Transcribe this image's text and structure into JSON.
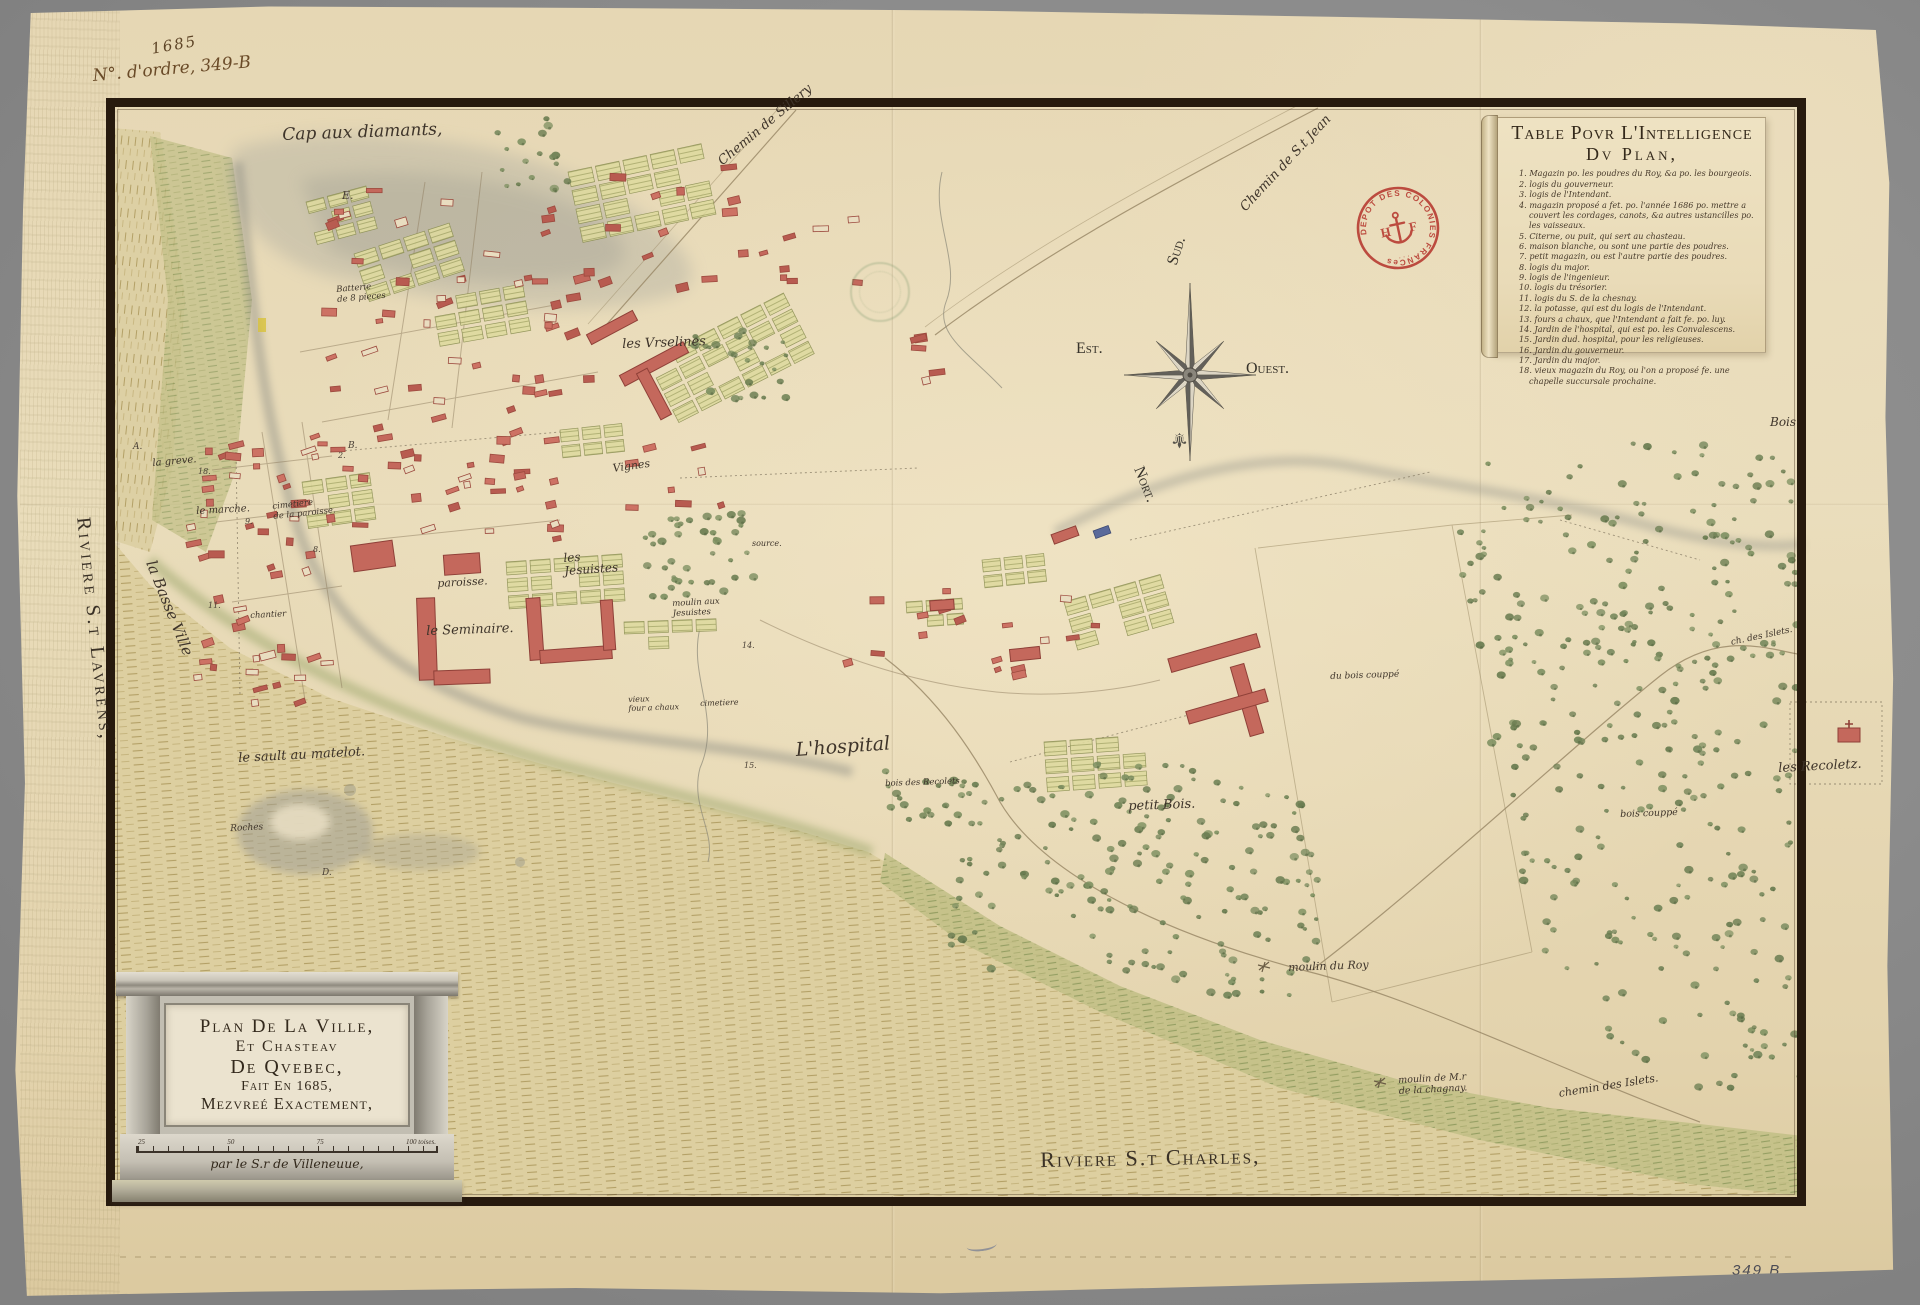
{
  "annotations": {
    "year": "1685",
    "order_number": "N°. d'ordre, 349-B",
    "corner_number": "349 B"
  },
  "legend": {
    "title_line1": "Table Povr L'Intelligence",
    "title_line2": "Dv Plan,",
    "items": [
      "Magazin po. les poudres du Roy, &a po. les bourgeois.",
      "logis du gouverneur.",
      "logis de l'Intendant.",
      "magazin proposé a fet. po. l'année 1686 po. mettre a couvert les cordages, canots, &a autres ustancilles po. les vaisseaux.",
      "Citerne, ou puit, qui sert au chasteau.",
      "maison blanche, ou sont une partie des poudres.",
      "petit magazin, ou est l'autre partie des poudres.",
      "logis du major.",
      "logis de l'ingenieur.",
      "logis du trésorier.",
      "logis du S. de la chesnay.",
      "la potasse, qui est du logis de l'Intendant.",
      "fours a chaux, que l'Intendant a fait fe. po. luy.",
      "Jardin de l'hospital, qui est po. les Convalescens.",
      "Jardin dud. hospital, pour les religieuses.",
      "Jardin du gouverneur.",
      "Jardin du major.",
      "vieux magazin du Roy, ou l'on a proposé fe. une chapelle succursale prochaine."
    ]
  },
  "cartouche": {
    "line1": "Plan De La Ville,",
    "line2": "Et Chasteav",
    "line3": "De Qvebec,",
    "line4": "Fait En 1685,",
    "line5": "Mezvreé Exactement,",
    "scale_labels": [
      "25",
      "50",
      "75",
      "100 toises."
    ],
    "author": "par le S.r de Villeneuue,"
  },
  "compass": {
    "north": "Nort.",
    "south": "Sud.",
    "east": "Est.",
    "west": "Ouest."
  },
  "stamps": {
    "red_text": "DEPOT DES COLONIES FRANCes",
    "red_h": "H",
    "red_f": "F"
  },
  "map_labels": [
    {
      "t": "Cap aux diamants,",
      "x": 282,
      "y": 126,
      "r": -2,
      "s": 17,
      "c": "scr"
    },
    {
      "t": "Chemin de Sillery",
      "x": 716,
      "y": 158,
      "r": -40,
      "s": 13,
      "c": "scr"
    },
    {
      "t": "Chemin de S.t Jean",
      "x": 1238,
      "y": 205,
      "r": -47,
      "s": 13,
      "c": "scr"
    },
    {
      "t": "E.",
      "x": 342,
      "y": 190,
      "r": 0,
      "s": 11,
      "c": "ink"
    },
    {
      "t": "les Vrselines",
      "x": 622,
      "y": 338,
      "r": -2,
      "s": 13,
      "c": "scr"
    },
    {
      "t": "Vignes",
      "x": 612,
      "y": 463,
      "r": -8,
      "s": 11,
      "c": "scr"
    },
    {
      "t": "les\nJesuistes",
      "x": 563,
      "y": 552,
      "r": -4,
      "s": 12,
      "c": "scr"
    },
    {
      "t": "paroisse.",
      "x": 437,
      "y": 578,
      "r": -3,
      "s": 11,
      "c": "scr"
    },
    {
      "t": "le Seminaire.",
      "x": 426,
      "y": 625,
      "r": -2,
      "s": 13,
      "c": "scr"
    },
    {
      "t": "moulin aux\nJesuistes",
      "x": 672,
      "y": 600,
      "r": -3,
      "s": 8.5,
      "c": "scr"
    },
    {
      "t": "source.",
      "x": 752,
      "y": 540,
      "r": 0,
      "s": 8,
      "c": "scr"
    },
    {
      "t": "la Basse Ville",
      "x": 158,
      "y": 558,
      "r": 68,
      "s": 15,
      "c": "scr"
    },
    {
      "t": "le marche.",
      "x": 196,
      "y": 506,
      "r": -3,
      "s": 10,
      "c": "scr"
    },
    {
      "t": "cimetiere\nde la paroisse.",
      "x": 272,
      "y": 503,
      "r": -6,
      "s": 8.5,
      "c": "scr"
    },
    {
      "t": "la greve.",
      "x": 152,
      "y": 458,
      "r": -5,
      "s": 10,
      "c": "scr"
    },
    {
      "t": "chantier",
      "x": 250,
      "y": 612,
      "r": -3,
      "s": 8.5,
      "c": "scr"
    },
    {
      "t": "le sault au matelot.",
      "x": 238,
      "y": 752,
      "r": -3,
      "s": 13,
      "c": "scr"
    },
    {
      "t": "vieux\nfour a chaux",
      "x": 628,
      "y": 696,
      "r": -2,
      "s": 8,
      "c": "scr"
    },
    {
      "t": "cimetiere",
      "x": 700,
      "y": 700,
      "r": -2,
      "s": 8,
      "c": "scr"
    },
    {
      "t": "L'hospital",
      "x": 795,
      "y": 740,
      "r": -4,
      "s": 19,
      "c": "scr"
    },
    {
      "t": "petit Bois.",
      "x": 1128,
      "y": 800,
      "r": -2,
      "s": 13,
      "c": "scr"
    },
    {
      "t": "bois des Recolets",
      "x": 885,
      "y": 780,
      "r": -2,
      "s": 8.5,
      "c": "scr"
    },
    {
      "t": "du bois couppé",
      "x": 1330,
      "y": 672,
      "r": -2,
      "s": 9,
      "c": "scr"
    },
    {
      "t": "bois couppé",
      "x": 1620,
      "y": 810,
      "r": -2,
      "s": 9.5,
      "c": "scr"
    },
    {
      "t": "moulin du Roy",
      "x": 1288,
      "y": 962,
      "r": -2,
      "s": 11,
      "c": "scr"
    },
    {
      "t": "moulin de M.r\nde la chagnay.",
      "x": 1398,
      "y": 1076,
      "r": -3,
      "s": 9.5,
      "c": "scr"
    },
    {
      "t": "chemin des Islets.",
      "x": 1558,
      "y": 1088,
      "r": -9,
      "s": 11,
      "c": "scr"
    },
    {
      "t": "ch. des Islets.",
      "x": 1730,
      "y": 638,
      "r": -12,
      "s": 9,
      "c": "scr"
    },
    {
      "t": "les Recoletz.",
      "x": 1778,
      "y": 762,
      "r": -3,
      "s": 13,
      "c": "scr"
    },
    {
      "t": "Bois",
      "x": 1770,
      "y": 416,
      "r": 0,
      "s": 12,
      "c": "scr"
    },
    {
      "t": "Roches",
      "x": 230,
      "y": 824,
      "r": -3,
      "s": 9,
      "c": "scr"
    },
    {
      "t": "Batterie\nde 8 pieces",
      "x": 336,
      "y": 286,
      "r": -5,
      "s": 8.5,
      "c": "scr"
    },
    {
      "t": "Riviere S.t Charles,",
      "x": 1040,
      "y": 1148,
      "r": -1,
      "s": 22,
      "c": "cap"
    },
    {
      "t": "Riviere S.t Lavrens,",
      "x": 94,
      "y": 516,
      "r": 84,
      "s": 20,
      "c": "cap vert"
    },
    {
      "t": "A.",
      "x": 133,
      "y": 442,
      "r": 0,
      "s": 9,
      "c": "ink"
    },
    {
      "t": "B.",
      "x": 348,
      "y": 441,
      "r": 0,
      "s": 9,
      "c": "ink"
    },
    {
      "t": "D.",
      "x": 322,
      "y": 868,
      "r": 0,
      "s": 9,
      "c": "ink"
    },
    {
      "t": "18.",
      "x": 198,
      "y": 468,
      "r": 0,
      "s": 8,
      "c": "ink"
    },
    {
      "t": "11.",
      "x": 208,
      "y": 602,
      "r": 0,
      "s": 8,
      "c": "ink"
    },
    {
      "t": "9.",
      "x": 245,
      "y": 518,
      "r": 0,
      "s": 8,
      "c": "ink"
    },
    {
      "t": "8.",
      "x": 313,
      "y": 546,
      "r": 0,
      "s": 8,
      "c": "ink"
    },
    {
      "t": "2.",
      "x": 338,
      "y": 452,
      "r": 0,
      "s": 8,
      "c": "ink"
    },
    {
      "t": "14.",
      "x": 742,
      "y": 642,
      "r": 0,
      "s": 8,
      "c": "ink"
    },
    {
      "t": "15.",
      "x": 744,
      "y": 762,
      "r": 0,
      "s": 8,
      "c": "ink"
    }
  ]
}
